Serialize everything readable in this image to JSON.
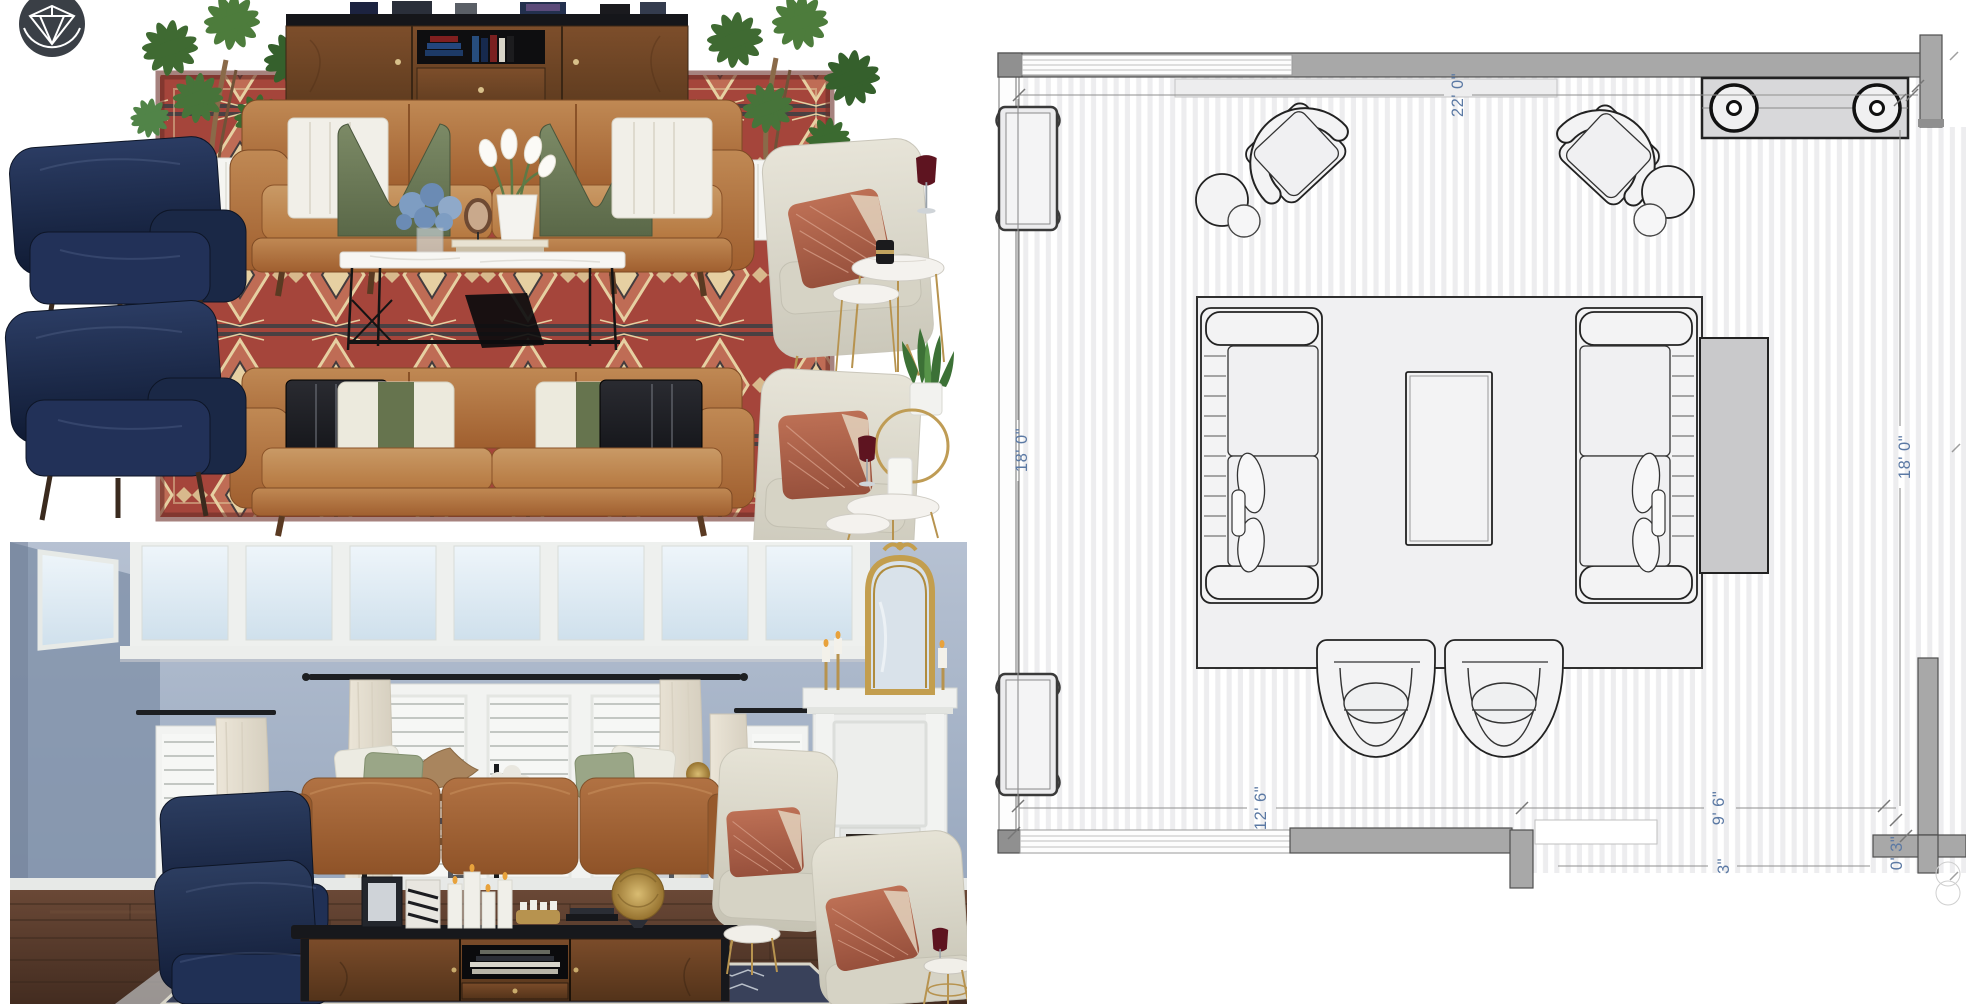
{
  "page": {
    "background": "#ffffff"
  },
  "logo": {
    "icon": "diamond-gem-badge",
    "background": "#3a3f46",
    "foreground": "#ffffff"
  },
  "moodboard": {
    "items": [
      "navy velvet armchairs",
      "kilim area rug",
      "walnut media console",
      "potted money trees",
      "caramel leather sofas",
      "marble coffee table",
      "ivory accent chairs",
      "marble nesting side tables",
      "rust pleated pillows",
      "olive velvet pillows",
      "calla lilies",
      "blue hydrangeas",
      "snake plant",
      "wine glasses"
    ],
    "palette": {
      "navy": "#1c2b4d",
      "leather": "#b5713e",
      "rug_red": "#a5453b",
      "olive": "#6d7c5a",
      "ivory": "#e3e0d4",
      "rust": "#b06450",
      "walnut": "#6e4526"
    }
  },
  "render": {
    "items": [
      "blue-gray walls",
      "clerestory windows",
      "plantation shutters",
      "cream curtains",
      "black ladder shelves",
      "white fireplace",
      "gold arched mirror",
      "leather sofa",
      "navy armchairs",
      "ivory accent chairs",
      "walnut media console",
      "pillar candles",
      "layered rugs",
      "dark wood floor"
    ],
    "palette": {
      "wall": "#9aa8bd",
      "floor": "#53381f",
      "fireplace": "#eef0ee",
      "mirror_gold": "#c9a050"
    }
  },
  "floor_plan": {
    "dimensions": {
      "top_width": "22' 0\"",
      "left_height": "18' 0\"",
      "right_height": "18' 0\"",
      "bottom_left": "12' 6\"",
      "bottom_right": "9' 6\"",
      "right_wall_gap": "0' 3\"",
      "bottom_partial": "3\""
    },
    "style": {
      "label_color": "#5b79a4",
      "wall_fill": "#a8a8a8",
      "floor_stripe": "#ededef",
      "furniture_fill": "#f3f3f4"
    }
  }
}
